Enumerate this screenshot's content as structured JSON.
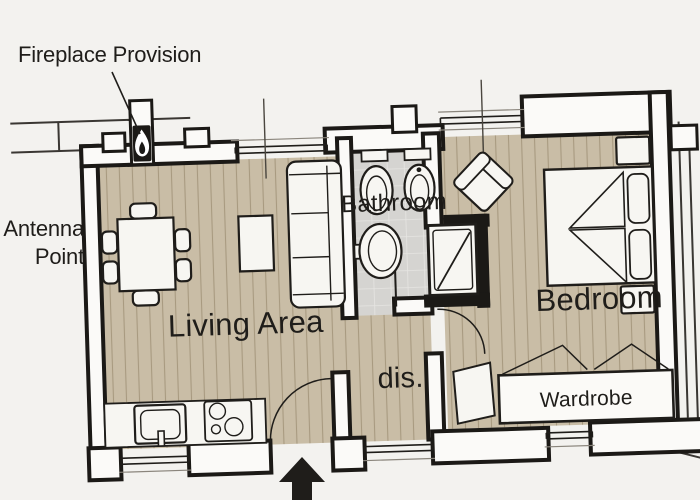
{
  "annotations": {
    "fireplace_provision": "Fireplace Provision",
    "antenna_point_line1": "Antenna",
    "antenna_point_line2": "Point"
  },
  "rooms": {
    "living_area": {
      "label": "Living Area"
    },
    "bathroom": {
      "label": "Bathroom"
    },
    "bedroom": {
      "label": "Bedroom"
    },
    "hallway": {
      "label": "dis."
    },
    "wardrobe": {
      "label": "Wardrobe"
    }
  },
  "icons": {
    "fireplace_flame": "flame-icon",
    "entrance_arrow": "arrow-up-icon"
  },
  "fixtures": [
    "dining-table",
    "dining-chairs",
    "coffee-table",
    "sofa",
    "kitchen-counter",
    "kitchen-sink",
    "cooktop",
    "toilet",
    "bidet",
    "washbasin",
    "shower",
    "armchair",
    "double-bed",
    "pillows",
    "nightstands",
    "wardrobe-unit",
    "bedside-table",
    "door-swings",
    "windows"
  ],
  "colors": {
    "bg": "#f3f2ef",
    "wall_fill": "#fbfaf8",
    "wall_stroke": "#1b1916",
    "ink": "#1f1d1a",
    "wood": "#c9bda6",
    "wood_line": "#a89a80",
    "tile": "#d5d4d1",
    "tile_line": "#e6e5e2",
    "furn": "#f7f6f2"
  }
}
